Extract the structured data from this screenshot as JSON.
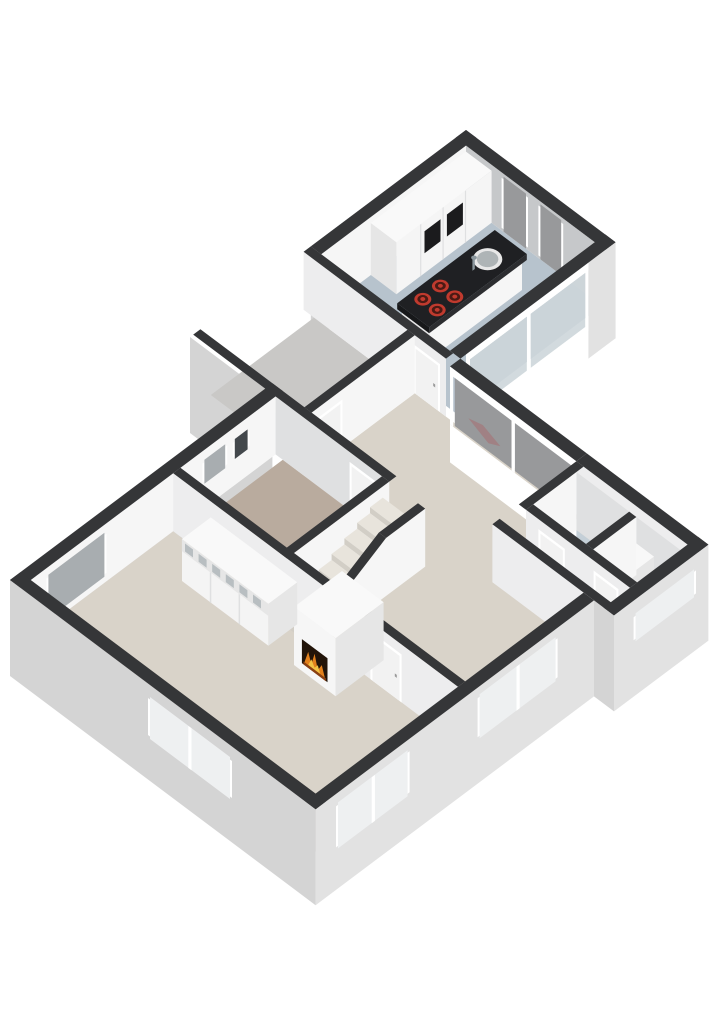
{
  "scene": {
    "kind": "3d-floorplan-isometric",
    "background": "#ffffff",
    "floor_level": "ground-floor",
    "walls_cut": true
  },
  "palette": {
    "bg": "#ffffff",
    "cap": "#353638",
    "extWall": "#d4d4d4",
    "extWallLight": "#e2e2e2",
    "intBright": "#f6f6f6",
    "intLight": "#ededee",
    "intMid": "#dfe0e1",
    "intGray": "#c6c8ca",
    "floorKitchen": "#b7c3cd",
    "floorBeige": "#d9d3c9",
    "floorBedroom": "#b9ab9e",
    "floorGarage": "#c9c8c6",
    "floorBlue": "#c4cfd7",
    "floorStairs": "#cfcabf",
    "frame": "#ffffff",
    "glassDark": "#98999b",
    "glassPane": "#cdd6da",
    "glassLight": "#eef0f1",
    "glassMid": "#a8adb0",
    "glassVent": "#43484c",
    "smudge": "#b0565a",
    "counterTop": "#1f2023",
    "counterSide": "#2c2d30",
    "counterEnd": "#17181a",
    "cabinet": "#f5f5f5",
    "cabinetTop": "#f9f9f9",
    "niche": "#1b1b1d",
    "burnerRing": "#c03a2e",
    "burnerDark": "#4a1a14",
    "fireboxDark": "#221409",
    "flameOrange": "#e2801c",
    "flameYellow": "#f2c245",
    "ember": "#8a4012",
    "applianceWhite": "#f4f4f4",
    "applianceShade": "#e6e6e6",
    "applianceTop": "#f8f8f8",
    "drumOuter": "#d8d8d8",
    "drumMid": "#aeb6ba",
    "drumDark": "#8a969c",
    "tread": "#e8e4dc",
    "riser": "#d2cec6",
    "doorLeaf": "#f2f2f2",
    "handle": "#9a9a9a",
    "sinkRim": "#e8e8e8",
    "sinkBasin": "#aeb4b6"
  },
  "rooms": [
    {
      "id": "kitchen",
      "floor_color": "floorKitchen"
    },
    {
      "id": "storage-room",
      "floor_color": "floorGarage"
    },
    {
      "id": "hall",
      "floor_color": "floorBeige"
    },
    {
      "id": "dining-area",
      "floor_color": "floorBeige"
    },
    {
      "id": "living-room",
      "floor_color": "floorBeige"
    },
    {
      "id": "bedroom",
      "floor_color": "floorBedroom"
    },
    {
      "id": "staircase-well",
      "floor_color": "floorStairs"
    },
    {
      "id": "toilet",
      "floor_color": "floorBlue"
    },
    {
      "id": "utility-room",
      "floor_color": "floorBlue"
    }
  ],
  "furniture": [
    {
      "id": "kitchen-island",
      "features": [
        "cooktop-4-burners",
        "sink",
        "faucet"
      ],
      "counter_color": "counterTop"
    },
    {
      "id": "kitchen-cabinet-run",
      "dark_niches": 2
    },
    {
      "id": "fireplace",
      "state": "lit"
    },
    {
      "id": "wardrobe",
      "sliding_panels": 3,
      "open_top_shelves": 6
    },
    {
      "id": "washing-machine"
    },
    {
      "id": "staircase",
      "treads": 8
    }
  ],
  "openings": {
    "kitchen_tall_windows": 2,
    "kitchen_sliding_glass_panels": 2,
    "hall_corner_glass_panels": 2,
    "bedroom_small_windows": 2,
    "west_wall_window": 1,
    "southwest_wall_window": 1,
    "southeast_wall_windows": 2,
    "utility_wing_window": 1,
    "interior_doors": 6
  }
}
